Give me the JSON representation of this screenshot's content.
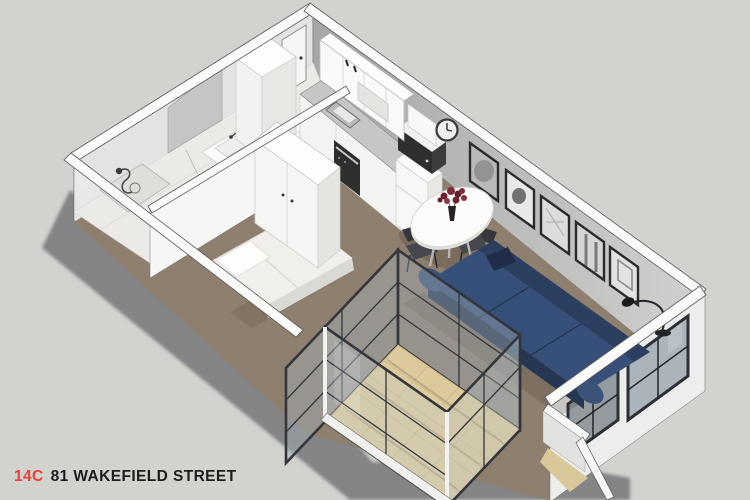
{
  "view": {
    "type": "3d-floorplan-render",
    "style": "isometric cutaway dollhouse view"
  },
  "caption": {
    "unit": "14C",
    "address": "81 WAKEFIELD STREET"
  },
  "palette": {
    "background": "#d2d3cf",
    "ground_shadow": "#828485",
    "wall_top": "#fafaf8",
    "wall_face_inner": "#b9bab8",
    "wall_face_outer": "#e9eae8",
    "carpet": "#8d7e6e",
    "kitchen_floor": "#f5f5f3",
    "bathroom_floor": "#eceae6",
    "balcony_floor": "#dcc99c",
    "sofa": "#36507a",
    "sofa_shadow": "#263753",
    "glass": "#aab4ba",
    "window_frame": "#33363a",
    "bed": "#f0efe9",
    "cabinet_white": "#f5f5f3",
    "counter": "#c6c7c5",
    "appliance_dark": "#2e2e2e",
    "chair": "#45494e",
    "flowers": "#7e2d3a",
    "accent_red": "#e8403a",
    "caption_text": "#1d1d1b"
  },
  "rooms": [
    {
      "name": "Bathroom",
      "items": [
        "shower",
        "vanity sink",
        "toilet",
        "mirror"
      ]
    },
    {
      "name": "Entry",
      "items": [
        "entry door",
        "hall cupboard"
      ]
    },
    {
      "name": "Kitchen",
      "items": [
        "upper cabinets",
        "bench sink",
        "oven",
        "fridge",
        "microwave",
        "wall clock"
      ]
    },
    {
      "name": "Dining",
      "items": [
        "round table",
        "2 chairs",
        "flower vase"
      ]
    },
    {
      "name": "Living",
      "items": [
        "navy sofa",
        "floor lamp",
        "5 picture frames",
        "windows"
      ]
    },
    {
      "name": "Sleeping nook",
      "items": [
        "bed",
        "wardrobe"
      ]
    },
    {
      "name": "Balcony",
      "items": [
        "glass enclosure",
        "tiled floor"
      ]
    }
  ]
}
